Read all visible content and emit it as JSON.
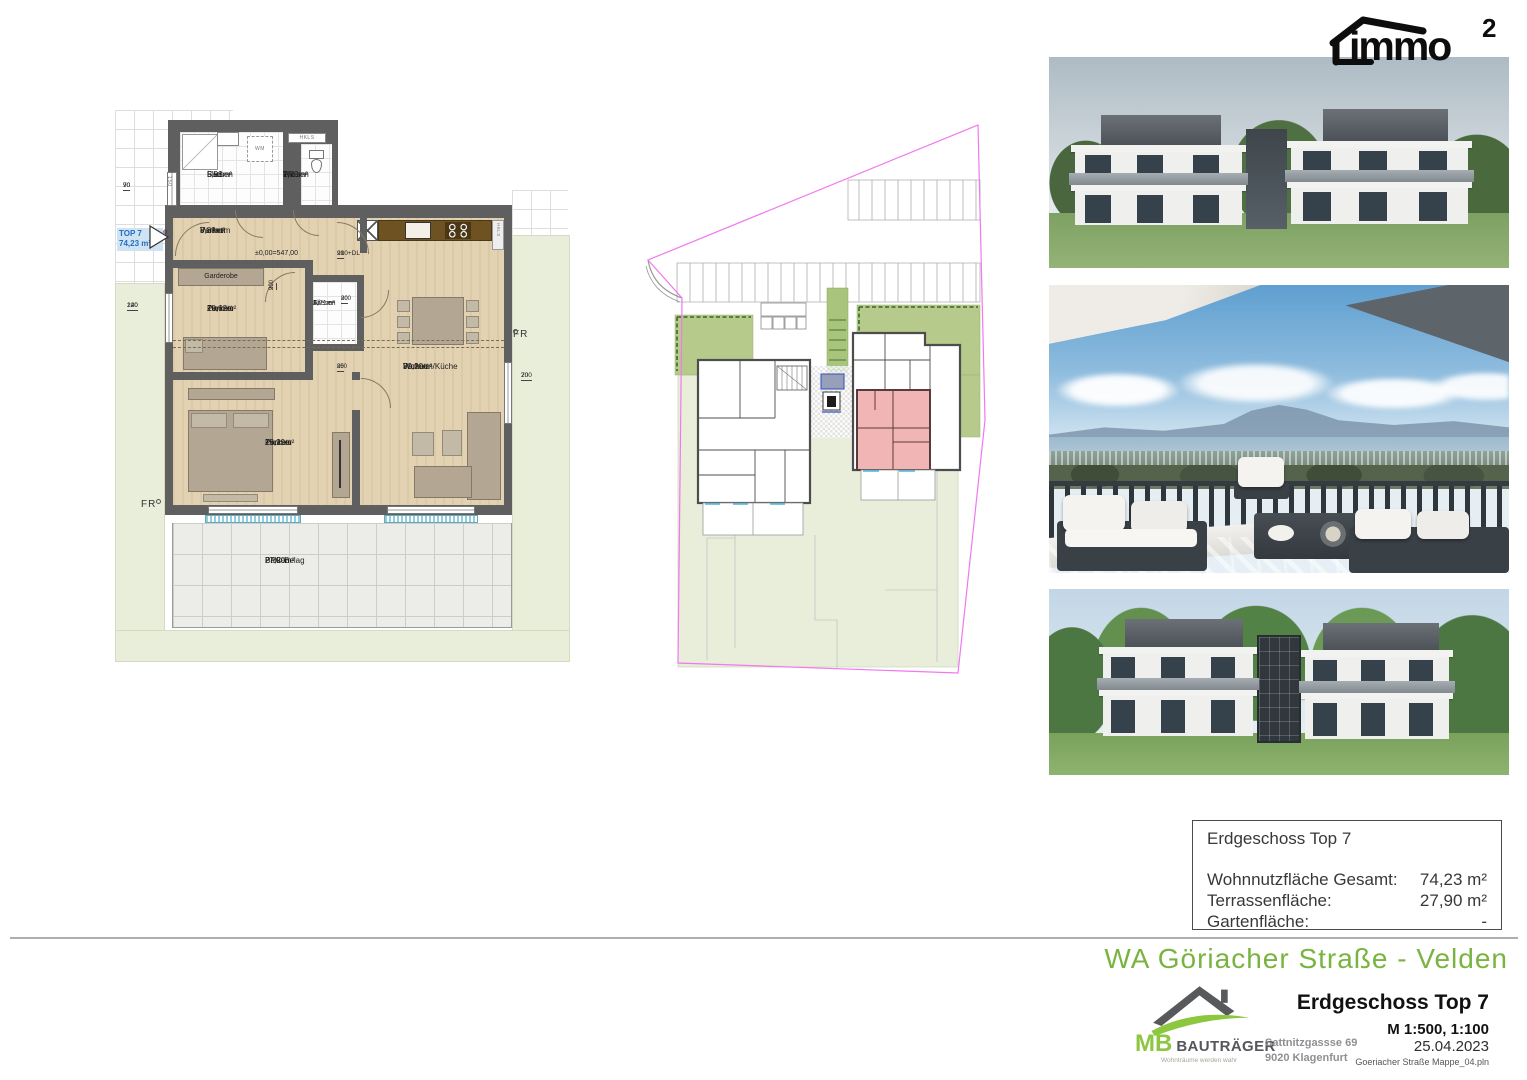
{
  "logo": {
    "text": "immo",
    "sup": "2"
  },
  "floorplan": {
    "unit_marker": {
      "line1": "TOP 7",
      "line2": "74,23 m²"
    },
    "level_label": "±0,00=547,00",
    "shaft_label_1": "HKLS",
    "shaft_label_2": "HKLS",
    "washer_label": "WM",
    "fr_left": "FR",
    "fr_right": "FR",
    "rooms": {
      "bad": {
        "name": "Bad",
        "area": "5,98m²",
        "floor": "Fliesen"
      },
      "wc": {
        "name": "Wc",
        "area": "1,70m²",
        "floor": "Fliesen"
      },
      "vorraum": {
        "name": "Vorraum",
        "area": "8,88m²",
        "floor": "Parkett"
      },
      "garderobe": {
        "name": "Garderobe"
      },
      "zimmer1": {
        "name": "Zimmer",
        "area": "10,62m²",
        "floor": "Parkett"
      },
      "ar": {
        "name": "Ar",
        "area": "1,71m²",
        "floor": "Fliesen"
      },
      "wohnen_kueche": {
        "name": "Wohnen/Küche",
        "area": "30,20m²",
        "floor": "Parkett"
      },
      "zimmer2": {
        "name": "Zimmer",
        "area": "15,29m²",
        "floor": "Parkett"
      },
      "balkon": {
        "name": "Balkon",
        "area": "27,90m²",
        "floor": "PPC-Belag"
      }
    },
    "dims": {
      "d90_70": {
        "t": "90",
        "b": "70"
      },
      "d90_210": {
        "t": "90",
        "b": "210"
      },
      "d120_240": {
        "t": "120",
        "b": "240"
      },
      "d200_70": {
        "t": "200",
        "b": "70"
      },
      "d90_210dl": {
        "t": "90",
        "b": "210+DL"
      },
      "d90_200": {
        "t": "90",
        "b": "200"
      },
      "d80_200": {
        "t": "80",
        "b": "200"
      },
      "d85_200": {
        "t": "85",
        "b": "200"
      },
      "d150": "150"
    }
  },
  "infobox": {
    "title": "Erdgeschoss Top 7",
    "rows": [
      {
        "label": "Wohnnutzfläche Gesamt:",
        "value": "74,23 m²"
      },
      {
        "label": "Terrassenfläche:",
        "value": "27,90 m²"
      },
      {
        "label": "Gartenfläche:",
        "value": "-"
      }
    ]
  },
  "footer": {
    "project_title": "WA Göriacher Straße - Velden",
    "sheet_title": "Erdgeschoss Top 7",
    "scale": "M 1:500, 1:100",
    "date": "25.04.2023",
    "file_name": "Goeriacher Straße Mappe_04.pln"
  },
  "company": {
    "initials": "MB",
    "name": "BAUTRÄGER",
    "tagline": "Wohnträume werden wahr",
    "address_line1": "Sattnitzgassse 69",
    "address_line2": "9020 Klagenfurt"
  },
  "colors": {
    "title_green": "#79b440",
    "logo_green": "#8dc63f",
    "boundary_magenta": "#f078f0",
    "highlight_pink": "#f2b5b5",
    "unit_marker_blue": "#1f6fc0",
    "wall_gray": "#5f5f5f"
  }
}
